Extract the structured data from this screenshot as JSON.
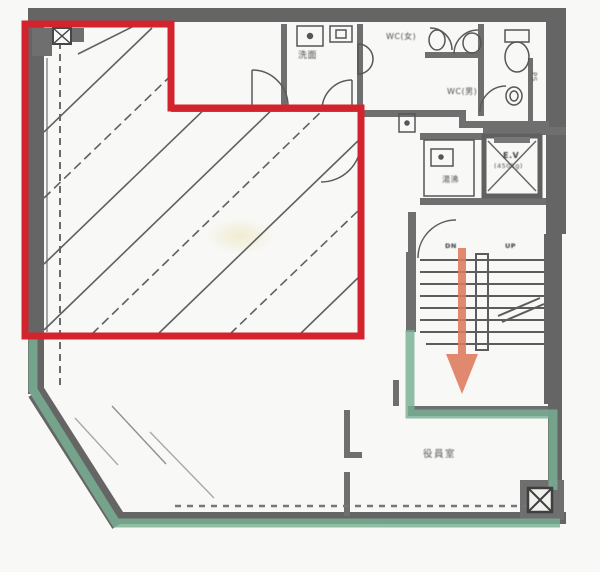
{
  "document": {
    "type": "scanned office floor plan with highlighted tenancy areas"
  },
  "colors": {
    "highlight_red": "#d6202a",
    "highlight_green": "#79b294",
    "arrow_salmon": "#e17a5b",
    "wall_gray": "#646464"
  },
  "rooms": {
    "washroom_label": "洗面",
    "wc_women_label": "WC(女)",
    "wc_men_label": "WC(男)",
    "pipe_shaft_label": "PS",
    "elevator_label": "E.V",
    "elevator_capacity": "(450kg)",
    "kitchenette_label": "湯沸",
    "office_label": "役員室"
  },
  "stairs": {
    "down_label": "DN",
    "up_label": "UP"
  }
}
